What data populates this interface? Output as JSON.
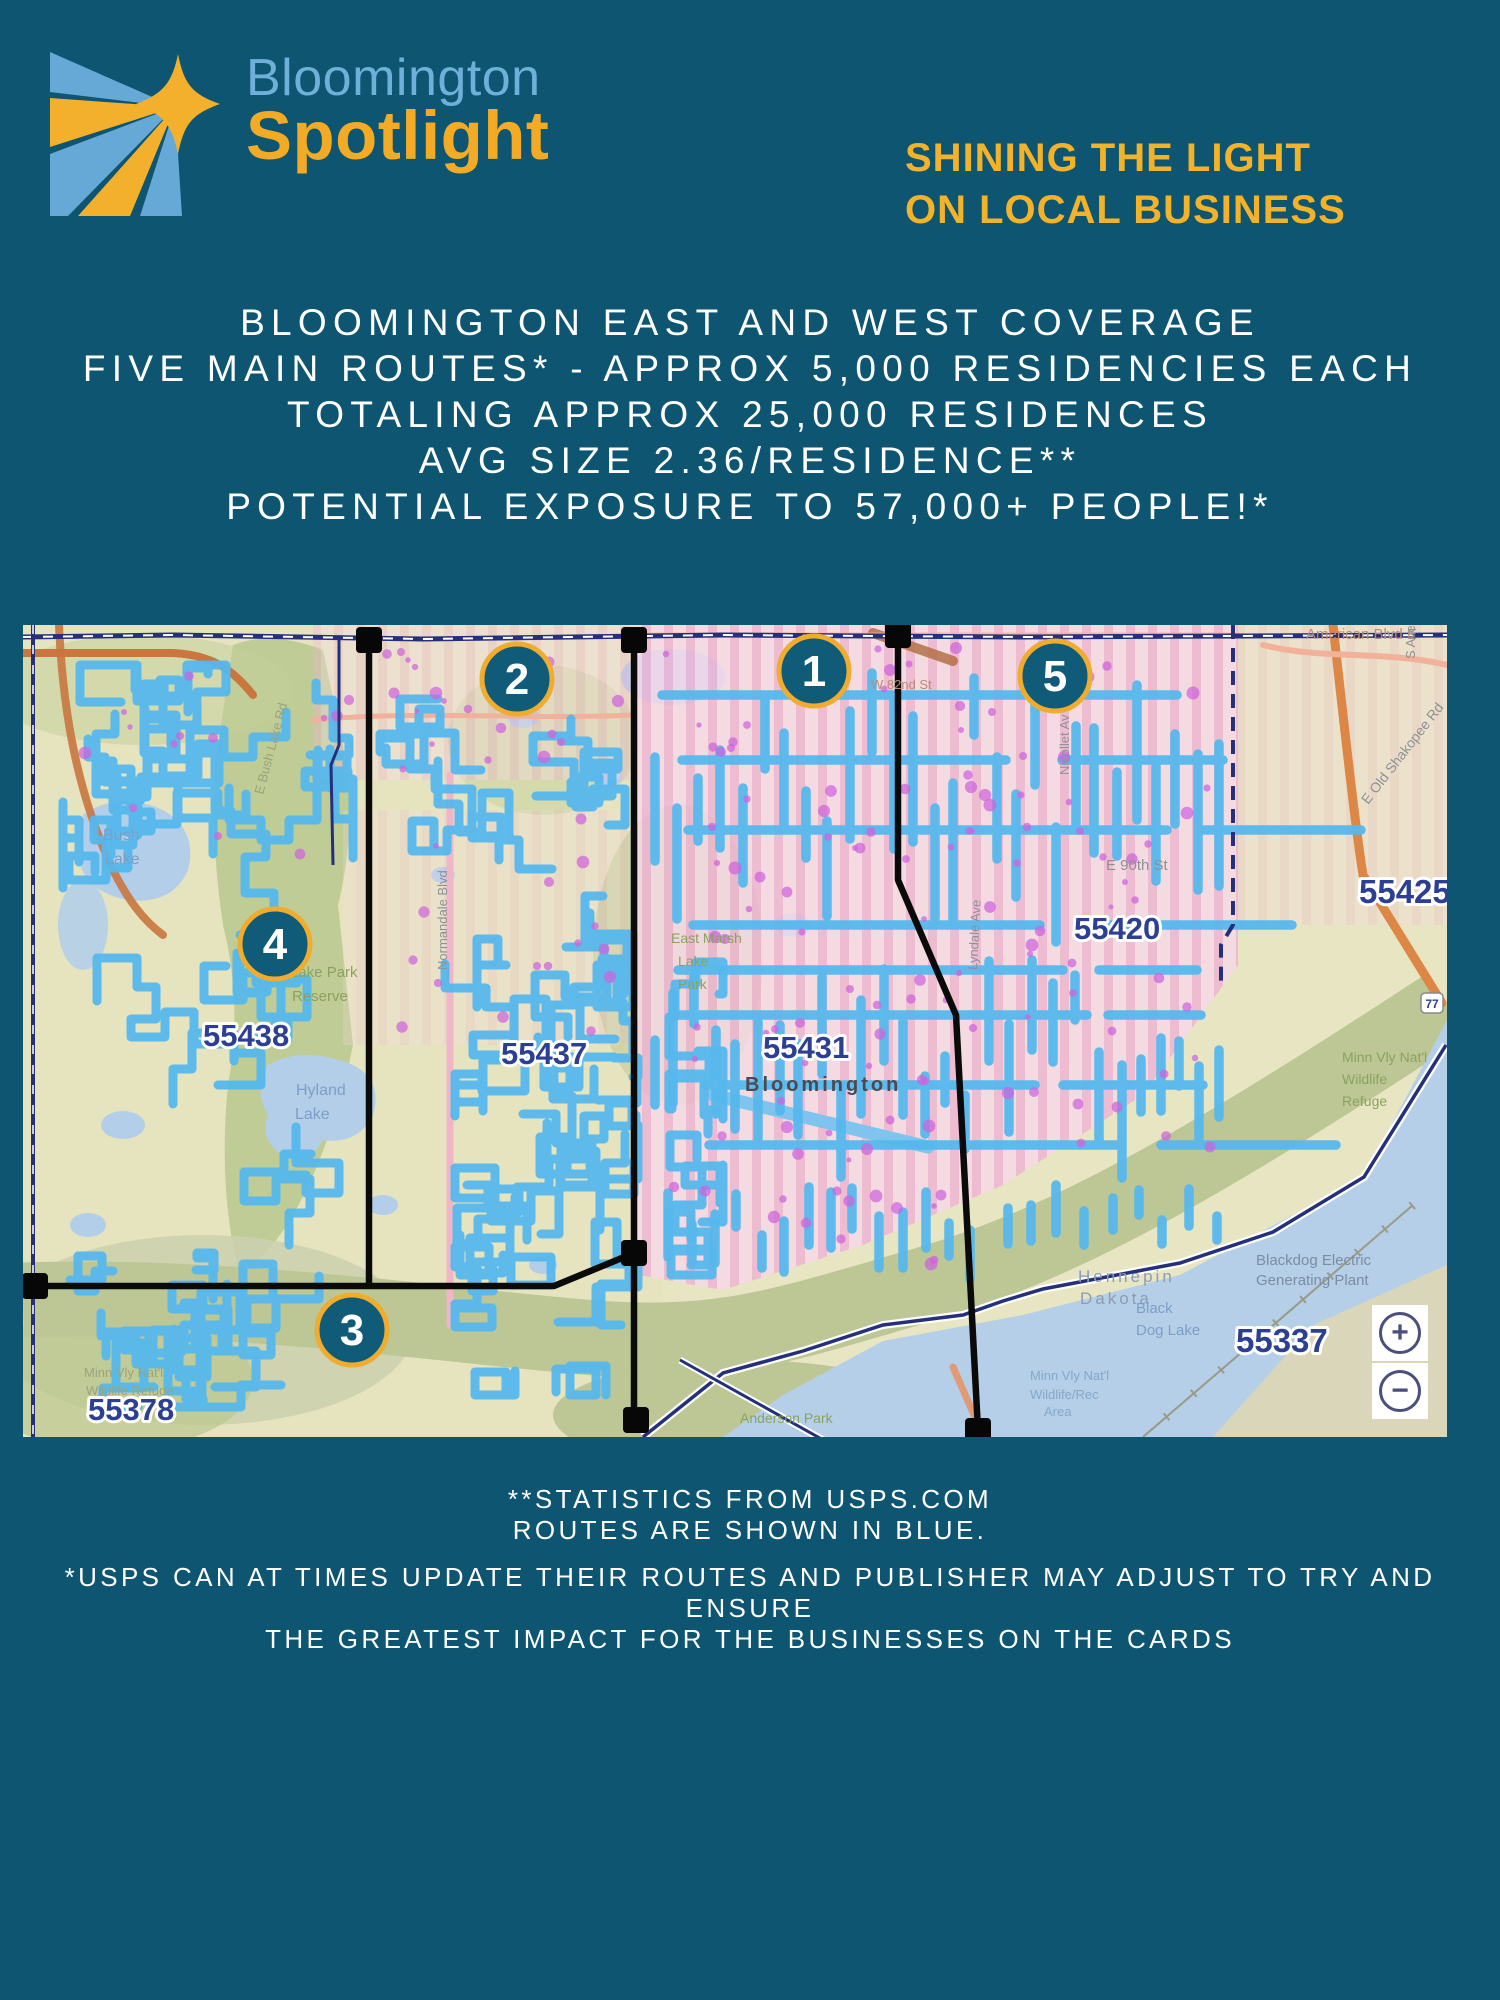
{
  "page": {
    "background_color": "#0d5570",
    "accent_yellow": "#f3b02c",
    "accent_light_blue": "#6fb0d9",
    "route_blue": "#55b7ec"
  },
  "logo": {
    "brand_top": "Bloomington",
    "brand_bottom": "Spotlight",
    "mark": "sunburst-star-logo"
  },
  "tagline": {
    "line1": "SHINING THE LIGHT",
    "line2": "ON LOCAL BUSINESS"
  },
  "headline": {
    "lines": [
      "BLOOMINGTON EAST AND WEST COVERAGE",
      "FIVE MAIN ROUTES* - APPROX 5,000 RESIDENCIES EACH",
      "TOTALING APPROX 25,000 RESIDENCES",
      "AVG SIZE 2.36/RESIDENCE**",
      "POTENTIAL EXPOSURE TO 57,000+ PEOPLE!*"
    ]
  },
  "map": {
    "route_markers": [
      {
        "number": "1",
        "x": 791,
        "y": 46
      },
      {
        "number": "2",
        "x": 494,
        "y": 54
      },
      {
        "number": "3",
        "x": 329,
        "y": 705
      },
      {
        "number": "4",
        "x": 252,
        "y": 319
      },
      {
        "number": "5",
        "x": 1032,
        "y": 51
      }
    ],
    "zip_labels": [
      {
        "text": "55438",
        "x": 180,
        "y": 421,
        "size": 31
      },
      {
        "text": "55437",
        "x": 478,
        "y": 439,
        "size": 31
      },
      {
        "text": "55431",
        "x": 740,
        "y": 433,
        "size": 31
      },
      {
        "text": "55420",
        "x": 1051,
        "y": 314,
        "size": 31
      },
      {
        "text": "55425",
        "x": 1336,
        "y": 278,
        "size": 33
      },
      {
        "text": "55378",
        "x": 65,
        "y": 795,
        "size": 31
      },
      {
        "text": "55337",
        "x": 1213,
        "y": 727,
        "size": 33
      }
    ],
    "place_labels": [
      {
        "text": "Bush",
        "x": 80,
        "y": 215,
        "c": "water",
        "size": 16
      },
      {
        "text": "Lake",
        "x": 82,
        "y": 239,
        "c": "water",
        "size": 16
      },
      {
        "text": "Hyland",
        "x": 273,
        "y": 470,
        "c": "water",
        "size": 16
      },
      {
        "text": "Lake",
        "x": 272,
        "y": 494,
        "c": "water",
        "size": 16
      },
      {
        "text": "Lake Park",
        "x": 267,
        "y": 352,
        "c": "park",
        "size": 15
      },
      {
        "text": "Reserve",
        "x": 269,
        "y": 376,
        "c": "park",
        "size": 15
      },
      {
        "text": "East Marsh",
        "x": 648,
        "y": 318,
        "c": "park",
        "size": 14
      },
      {
        "text": "Lake",
        "x": 655,
        "y": 341,
        "c": "park",
        "size": 14
      },
      {
        "text": "Park",
        "x": 655,
        "y": 364,
        "c": "park",
        "size": 14
      },
      {
        "text": "Bloomington",
        "x": 722,
        "y": 466,
        "c": "city",
        "size": 20,
        "ls": 3
      },
      {
        "text": "E 90th St",
        "x": 1083,
        "y": 245,
        "c": "road",
        "size": 15
      },
      {
        "text": "American Blvd E",
        "x": 1283,
        "y": 14,
        "c": "roadwarm",
        "size": 15
      },
      {
        "text": "W 82nd St",
        "x": 848,
        "y": 64,
        "c": "roadwarm",
        "size": 13
      },
      {
        "text": "E Old Shakopee Rd",
        "x": 1345,
        "y": 180,
        "c": "road",
        "size": 14,
        "r": -52
      },
      {
        "text": "E Bush Lake Rd",
        "x": 240,
        "y": 170,
        "c": "parkdim",
        "size": 13,
        "r": -75
      },
      {
        "text": "Normandale Blvd",
        "x": 424,
        "y": 345,
        "c": "road",
        "size": 13,
        "r": -90
      },
      {
        "text": "Lyndale Ave",
        "x": 954,
        "y": 345,
        "c": "road",
        "size": 13,
        "r": -87
      },
      {
        "text": "Nicollet Av",
        "x": 1046,
        "y": 150,
        "c": "road",
        "size": 13,
        "r": -90
      },
      {
        "text": "S Ave",
        "x": 1392,
        "y": 34,
        "c": "road",
        "size": 13,
        "r": -90
      },
      {
        "text": "Minn Vly Nat'l",
        "x": 1319,
        "y": 437,
        "c": "park",
        "size": 14
      },
      {
        "text": "Wildlife",
        "x": 1319,
        "y": 459,
        "c": "park",
        "size": 14
      },
      {
        "text": "Refuge",
        "x": 1319,
        "y": 481,
        "c": "park",
        "size": 14
      },
      {
        "text": "Hennepin",
        "x": 1055,
        "y": 657,
        "c": "county",
        "size": 17
      },
      {
        "text": "Dakota",
        "x": 1057,
        "y": 679,
        "c": "county",
        "size": 17
      },
      {
        "text": "Blackdog Electric",
        "x": 1233,
        "y": 640,
        "c": "plant",
        "size": 15
      },
      {
        "text": "Generating Plant",
        "x": 1233,
        "y": 660,
        "c": "plant",
        "size": 15
      },
      {
        "text": "Black",
        "x": 1113,
        "y": 688,
        "c": "water",
        "size": 15
      },
      {
        "text": "Dog Lake",
        "x": 1113,
        "y": 710,
        "c": "water",
        "size": 15
      },
      {
        "text": "Minn Vly Nat'l",
        "x": 1007,
        "y": 755,
        "c": "waterdim",
        "size": 13
      },
      {
        "text": "Wildlife/Rec",
        "x": 1007,
        "y": 774,
        "c": "waterdim",
        "size": 13
      },
      {
        "text": "Area",
        "x": 1021,
        "y": 791,
        "c": "waterdim",
        "size": 13
      },
      {
        "text": "Anderson Park",
        "x": 717,
        "y": 798,
        "c": "park",
        "size": 14
      },
      {
        "text": "Minn Vly Nat'l",
        "x": 61,
        "y": 752,
        "c": "parkdim",
        "size": 13
      },
      {
        "text": "Wildlife Refuge",
        "x": 63,
        "y": 770,
        "c": "parkdim",
        "size": 13
      }
    ],
    "road_shield": "77",
    "zoom_controls": {
      "zoom_in": "+",
      "zoom_out": "−"
    },
    "legend_note": "Routes are shown in blue",
    "marker_fill": "#0f5b78",
    "marker_ring": "#efac2e"
  },
  "footnotes": {
    "block1": [
      "**STATISTICS FROM USPS.COM",
      "ROUTES ARE SHOWN IN BLUE."
    ],
    "block2": [
      "*USPS CAN AT TIMES UPDATE THEIR ROUTES AND PUBLISHER MAY ADJUST TO TRY AND ENSURE",
      "THE GREATEST IMPACT FOR THE BUSINESSES ON THE CARDS"
    ]
  }
}
